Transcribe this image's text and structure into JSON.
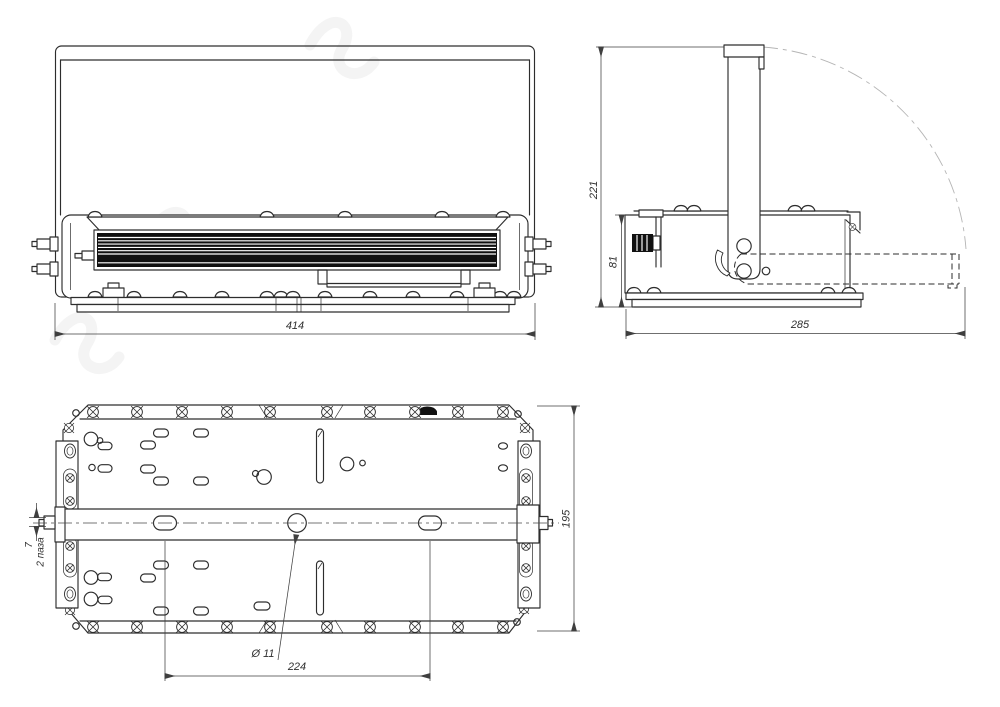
{
  "dimensions": {
    "front_width": "414",
    "side_total_height": "221",
    "side_body_height": "81",
    "side_depth": "285",
    "bottom_height": "195",
    "mount_hole_spacing": "224",
    "mount_hole_diameter": "Ø 11",
    "slot_width": "7",
    "slot_note": "2 паза"
  },
  "colors": {
    "line": "#2d2d2d",
    "dimension": "#3f3f3f",
    "heatsink_fill": "#111111",
    "phantom_arc": "#b5b5b5",
    "background": "#ffffff",
    "watermark": "#ededed"
  }
}
